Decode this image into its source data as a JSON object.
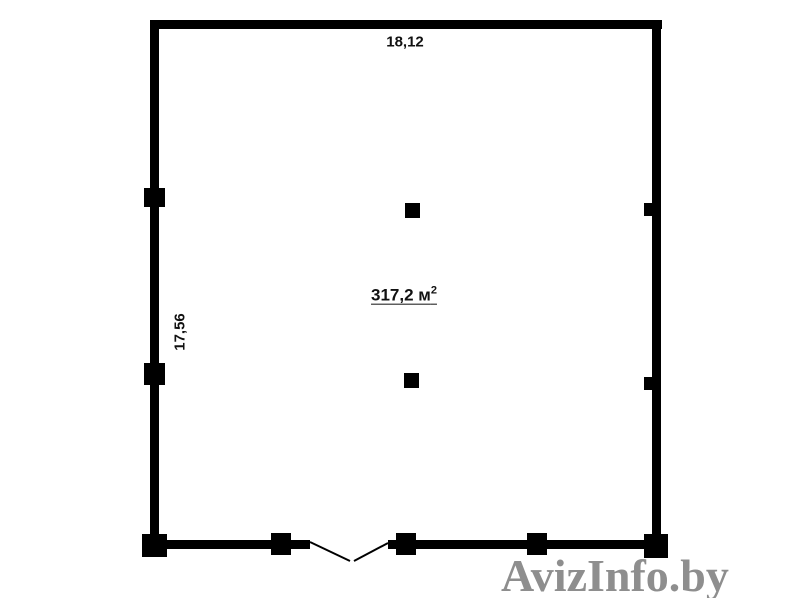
{
  "floor_plan": {
    "width_dimension": "18,12",
    "height_dimension": "17,56",
    "area_value": "317,2 м",
    "area_superscript": "2"
  },
  "watermark": {
    "text": "AvizInfo.by"
  },
  "colors": {
    "wall": "#000000",
    "background": "#ffffff",
    "watermark_gray": "#8e8e8e",
    "text": "#111111"
  }
}
